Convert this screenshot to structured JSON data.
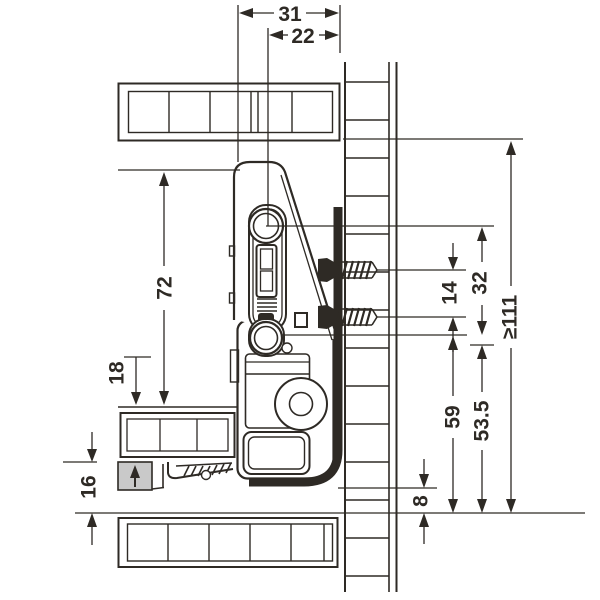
{
  "drawing": {
    "colors": {
      "line": "#2e2a25",
      "drawer_bottom_fill": "#c9c9c9",
      "background": "#ffffff"
    },
    "dims": {
      "top_31": "31",
      "top_22": "22",
      "left_72": "72",
      "left_18": "18",
      "left_16": "16",
      "right_14": "14",
      "right_32": "32",
      "right_min111": "≥111",
      "right_59": "59",
      "right_53_5": "53.5",
      "right_8": "8"
    }
  }
}
